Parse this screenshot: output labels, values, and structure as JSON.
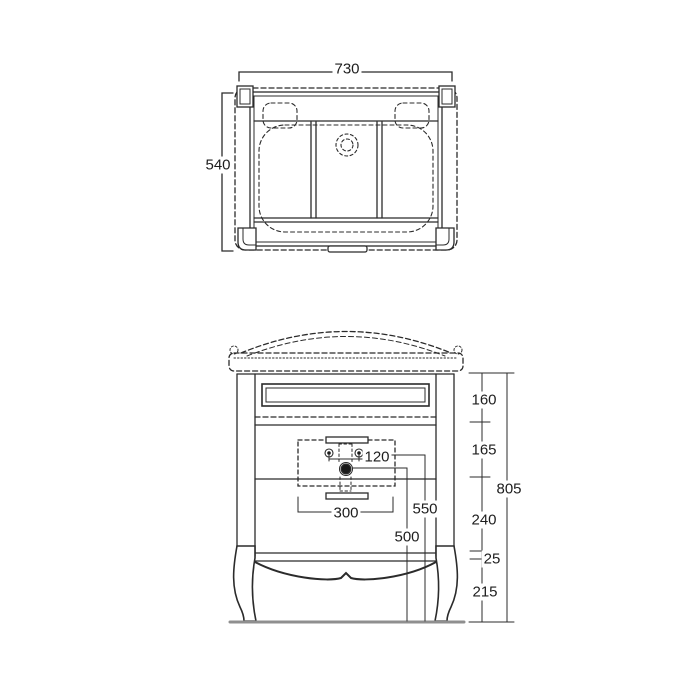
{
  "drawing": {
    "colors": {
      "line": "#2b2b2b",
      "dashed": "#3a3a3a",
      "ground": "#8f8f8f",
      "fill": "#1a1a1a"
    },
    "top_view": {
      "width": "730",
      "depth": "540"
    },
    "front_view": {
      "tap_hole_spacing": "120",
      "handle_width": "300",
      "supply_height": "550",
      "drain_height": "500",
      "segment_top_drawer": "160",
      "segment_basin_zone": "165",
      "segment_middle": "240",
      "segment_rail": "25",
      "segment_legs": "215",
      "total_height": "805"
    }
  }
}
